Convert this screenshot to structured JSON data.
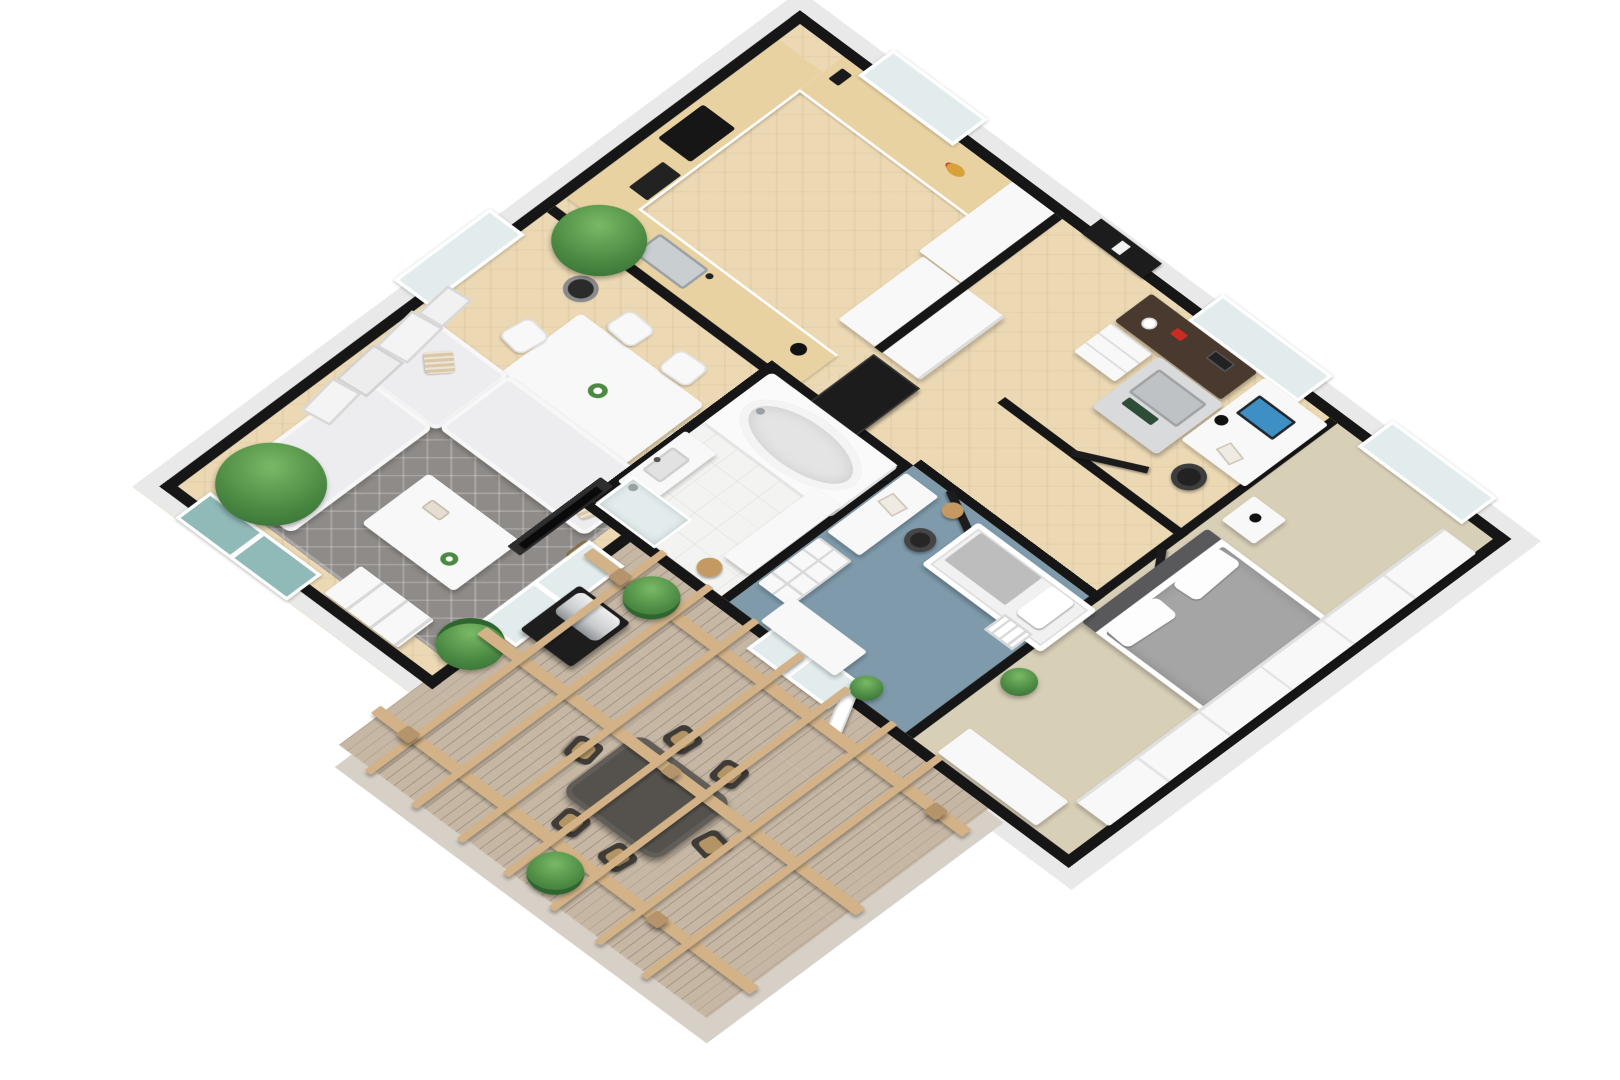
{
  "scene": {
    "title": "3D isometric floor plan render — apartment with pergola terrace",
    "view": "isometric 3D floorplan, white background, no visible text labels"
  },
  "palette": {
    "wall": "#161616",
    "base_gray": "#e9e9e9",
    "deck_base": "#d7d0c7",
    "wood": "#ecd9b4",
    "counter": "#e9d2a2",
    "tile": "#f3f3f1",
    "rug": "#8e8b88",
    "carpet_tan": "#d8cfb7",
    "carpet_blue": "#7e9aab",
    "deck": "#c6b7a4",
    "pergola": "#d2b286",
    "pergola_dark": "#b5946c",
    "furn_white": "#f8f8f8",
    "sofa": "#ededef",
    "pillow_beige": "#d9c7a8",
    "door_black": "#1c1c1c",
    "glass": "#e2ecec",
    "teal_glass": "#8fbab8",
    "metal": "#c9ced1",
    "screen_blue": "#3e8fc4",
    "duvet": "#a5a5a5",
    "headboard": "#59595c",
    "desk_dark": "#4a392e",
    "accent_red": "#cc2a22",
    "grill_body": "#1d1d1d",
    "grill_lid": "#c9ccce",
    "out_table": "#55514c",
    "out_chair": "#3f3c38",
    "chair_tan": "#b29465",
    "plant": "#4c8a43",
    "plant_dark": "#2f6630",
    "stool_wood": "#c49a62"
  },
  "rooms": [
    {
      "id": "living",
      "name": "Open living / kitchen / dining",
      "floor": "light herringbone wood",
      "furniture": [
        "L-shaped kitchen counter with black cooktop and oven",
        "window counter with fruit bowl and coffee maker",
        "sink peninsula with faucet and black kettle",
        "half wall behind peninsula",
        "tall white cabinet column",
        "entry wardrobe volume",
        "dining table with flower centerpiece",
        "6 white dining chairs",
        "black multi-arm floor lamp",
        "white corner sofa with beige cushions",
        "gray diamond-pattern area rug",
        "white coffee table with plant and tray",
        "wicker basket",
        "TV on media wall",
        "2x2 white storage cube",
        "sliding glass door to garden (teal glass)",
        "sliding glass door to terrace",
        "leaning art frames (4)",
        "potted tree near window",
        "large potted tree in corner",
        "monstera plant"
      ]
    },
    {
      "id": "entry",
      "name": "Entry hall",
      "floor": "light herringbone wood",
      "furniture": [
        "black front door with glass panel",
        "tall black coat closet",
        "black interior doors (office, bathroom, bedroom, kids room)"
      ]
    },
    {
      "id": "office",
      "name": "Home office",
      "floor": "light wood",
      "furniture": [
        "dark sideboard desk with red phone, books and mug",
        "white drawer unit",
        "gray multifunction printer-copier",
        "white desk under window",
        "monitor with blue screen",
        "black office chair",
        "black vase"
      ]
    },
    {
      "id": "bathroom",
      "name": "Bathroom",
      "floor": "white tile",
      "furniture": [
        "oval corner bathtub in white surround",
        "vanity with sink and faucet",
        "walk-in shower with glass",
        "tall white storage cabinet",
        "round wooden stool"
      ]
    },
    {
      "id": "bedroom",
      "name": "Master bedroom",
      "floor": "beige carpet",
      "furniture": [
        "double bed with gray duvet and two white pillows",
        "dark headboard",
        "nightstand with black lamp",
        "full-length white wardrobe",
        "low white cabinet at foot wall",
        "potted plant",
        "window"
      ]
    },
    {
      "id": "kids",
      "name": "Kids room",
      "floor": "blue carpet",
      "furniture": [
        "white bunk bed with ladder and pillow",
        "white desk with open magazine",
        "black desk chair",
        "white cubby bookshelf",
        "white dresser",
        "round wooden stool",
        "potted plant",
        "French doors to terrace"
      ]
    },
    {
      "id": "terrace",
      "name": "Terrace / deck",
      "floor": "weathered wood planks",
      "furniture": [
        "timber pergola with posts, cross beams and slats",
        "gas grill with stainless lid",
        "dark outdoor dining table",
        "6 outdoor chairs with tan seats",
        "potted fern (2)"
      ]
    }
  ],
  "openings": {
    "windows": [
      "kitchen window (top-right wall)",
      "office window (top-right wall)",
      "bedroom window (top-right wall)",
      "living room window (top-left wall)"
    ],
    "doors": [
      "black front door",
      "office door",
      "bathroom door",
      "bedroom door",
      "kids room door",
      "sliding glass door (left wall)",
      "sliding glass door to terrace",
      "French doors to terrace"
    ]
  }
}
